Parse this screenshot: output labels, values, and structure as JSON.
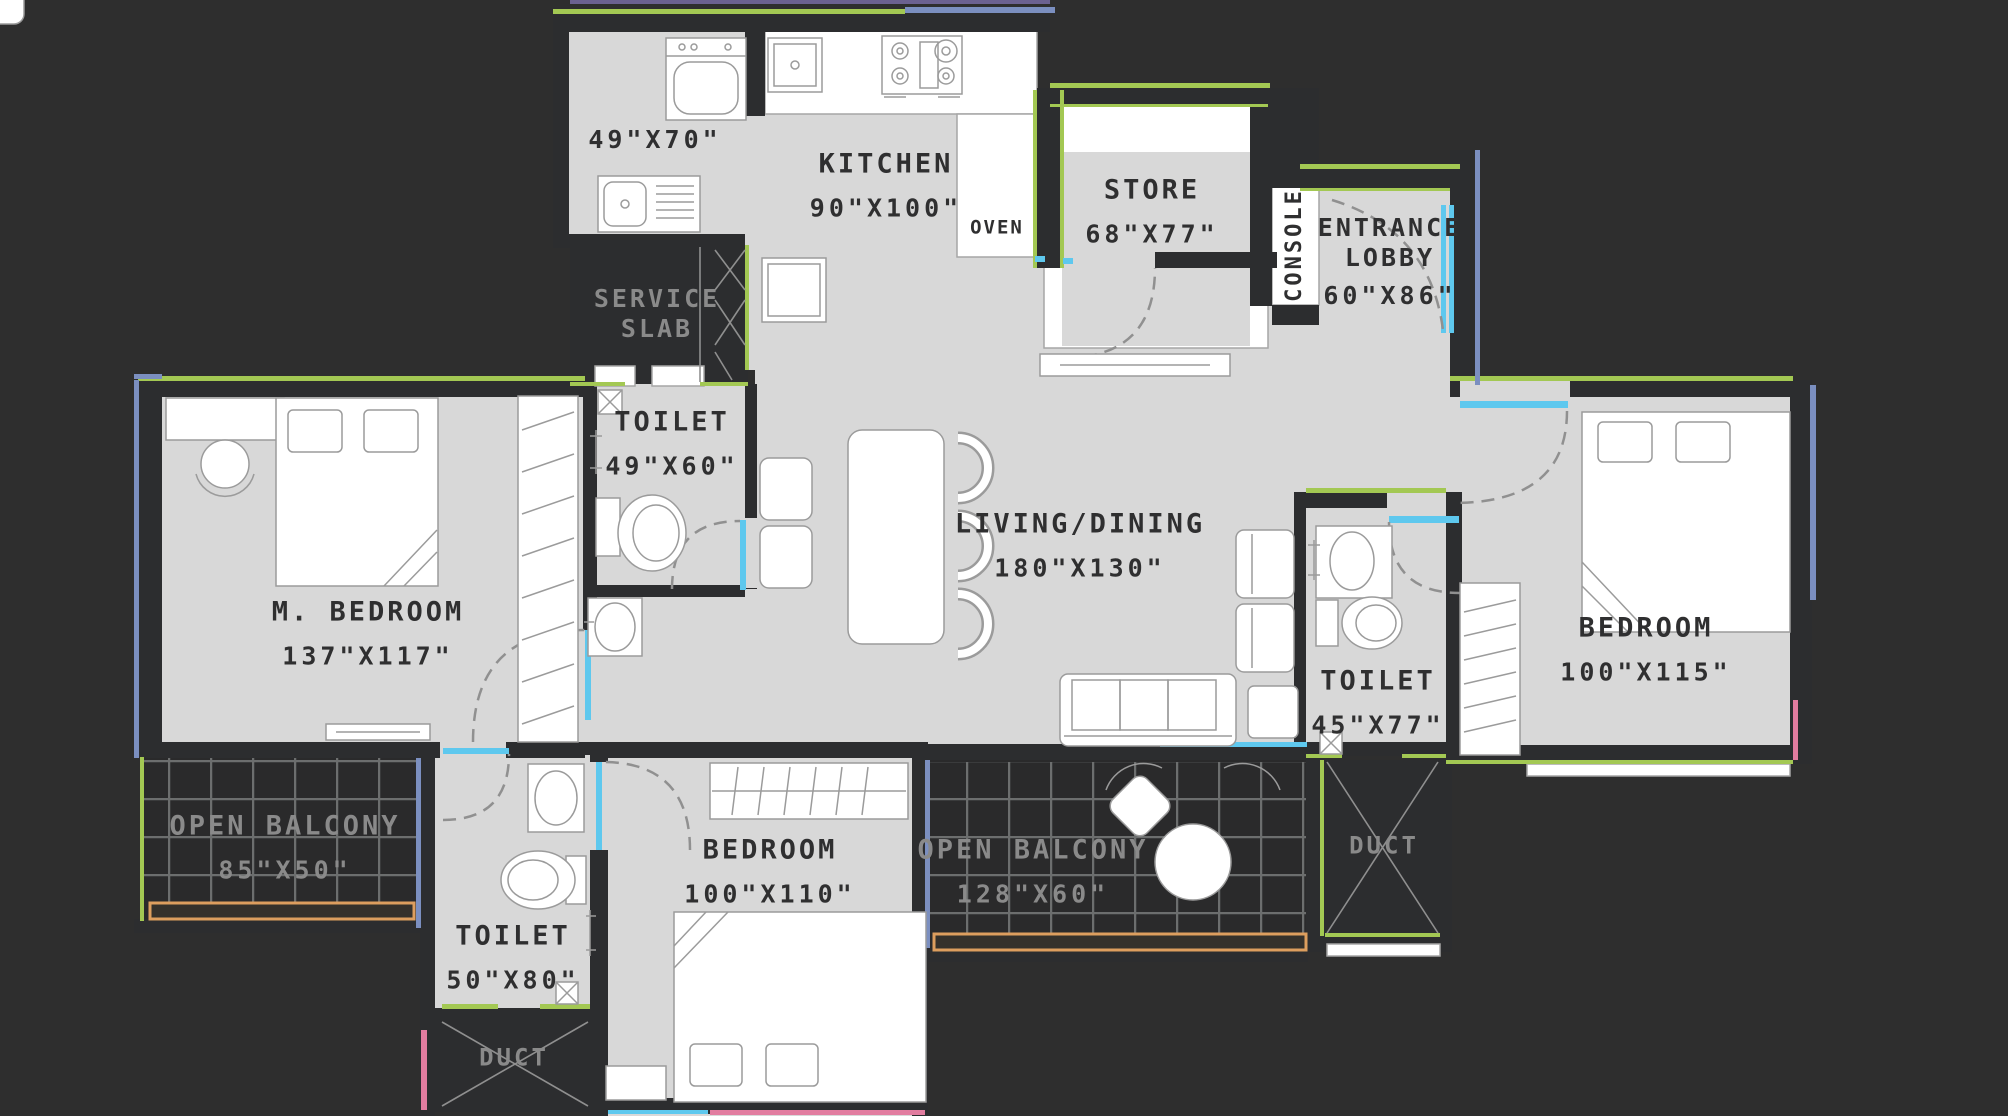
{
  "plan": {
    "rooms": {
      "utility": {
        "dims": "49\"X70\""
      },
      "kitchen": {
        "name": "KITCHEN",
        "dims": "90\"X100\""
      },
      "oven": {
        "name": "OVEN"
      },
      "store": {
        "name": "STORE",
        "dims": "68\"X77\""
      },
      "console": {
        "name": "CONSOLE"
      },
      "entrance_lobby": {
        "name": "ENTRANCE LOBBY",
        "dims": "60\"X86\""
      },
      "service_slab": {
        "name": "SERVICE SLAB"
      },
      "toilet_top": {
        "name": "TOILET",
        "dims": "49\"X60\""
      },
      "m_bedroom": {
        "name": "M. BEDROOM",
        "dims": "137\"X117\""
      },
      "living_dining": {
        "name": "LIVING/DINING",
        "dims": "180\"X130\""
      },
      "bedroom_right": {
        "name": "BEDROOM",
        "dims": "100\"X115\""
      },
      "toilet_right": {
        "name": "TOILET",
        "dims": "45\"X77\""
      },
      "balcony_left": {
        "name": "OPEN BALCONY",
        "dims": "85\"X50\""
      },
      "toilet_bottom": {
        "name": "TOILET",
        "dims": "50\"X80\""
      },
      "duct_bottom": {
        "name": "DUCT"
      },
      "bedroom_bottom": {
        "name": "BEDROOM",
        "dims": "100\"X110\""
      },
      "balcony_center": {
        "name": "OPEN BALCONY",
        "dims": "128\"X60\""
      },
      "duct_right": {
        "name": "DUCT"
      }
    },
    "colors": {
      "background": "#2e2e2e",
      "floor": "#d8d8d8",
      "wall": "#2c2d2f",
      "furniture": "#ffffff",
      "exterior_green": "#a3c853",
      "window_blue": "#7b8fc0",
      "door_cyan": "#5ec8ee",
      "accent_pink": "#e27da0",
      "accent_orange": "#dd9e5e",
      "accent_purple": "#6b6190",
      "label_dark": "#2f2f30",
      "label_gray": "#8a8a8a",
      "grid_line": "#6c6e6e",
      "swing_line": "#909090",
      "fixture_stroke": "#9b9b9b"
    }
  }
}
